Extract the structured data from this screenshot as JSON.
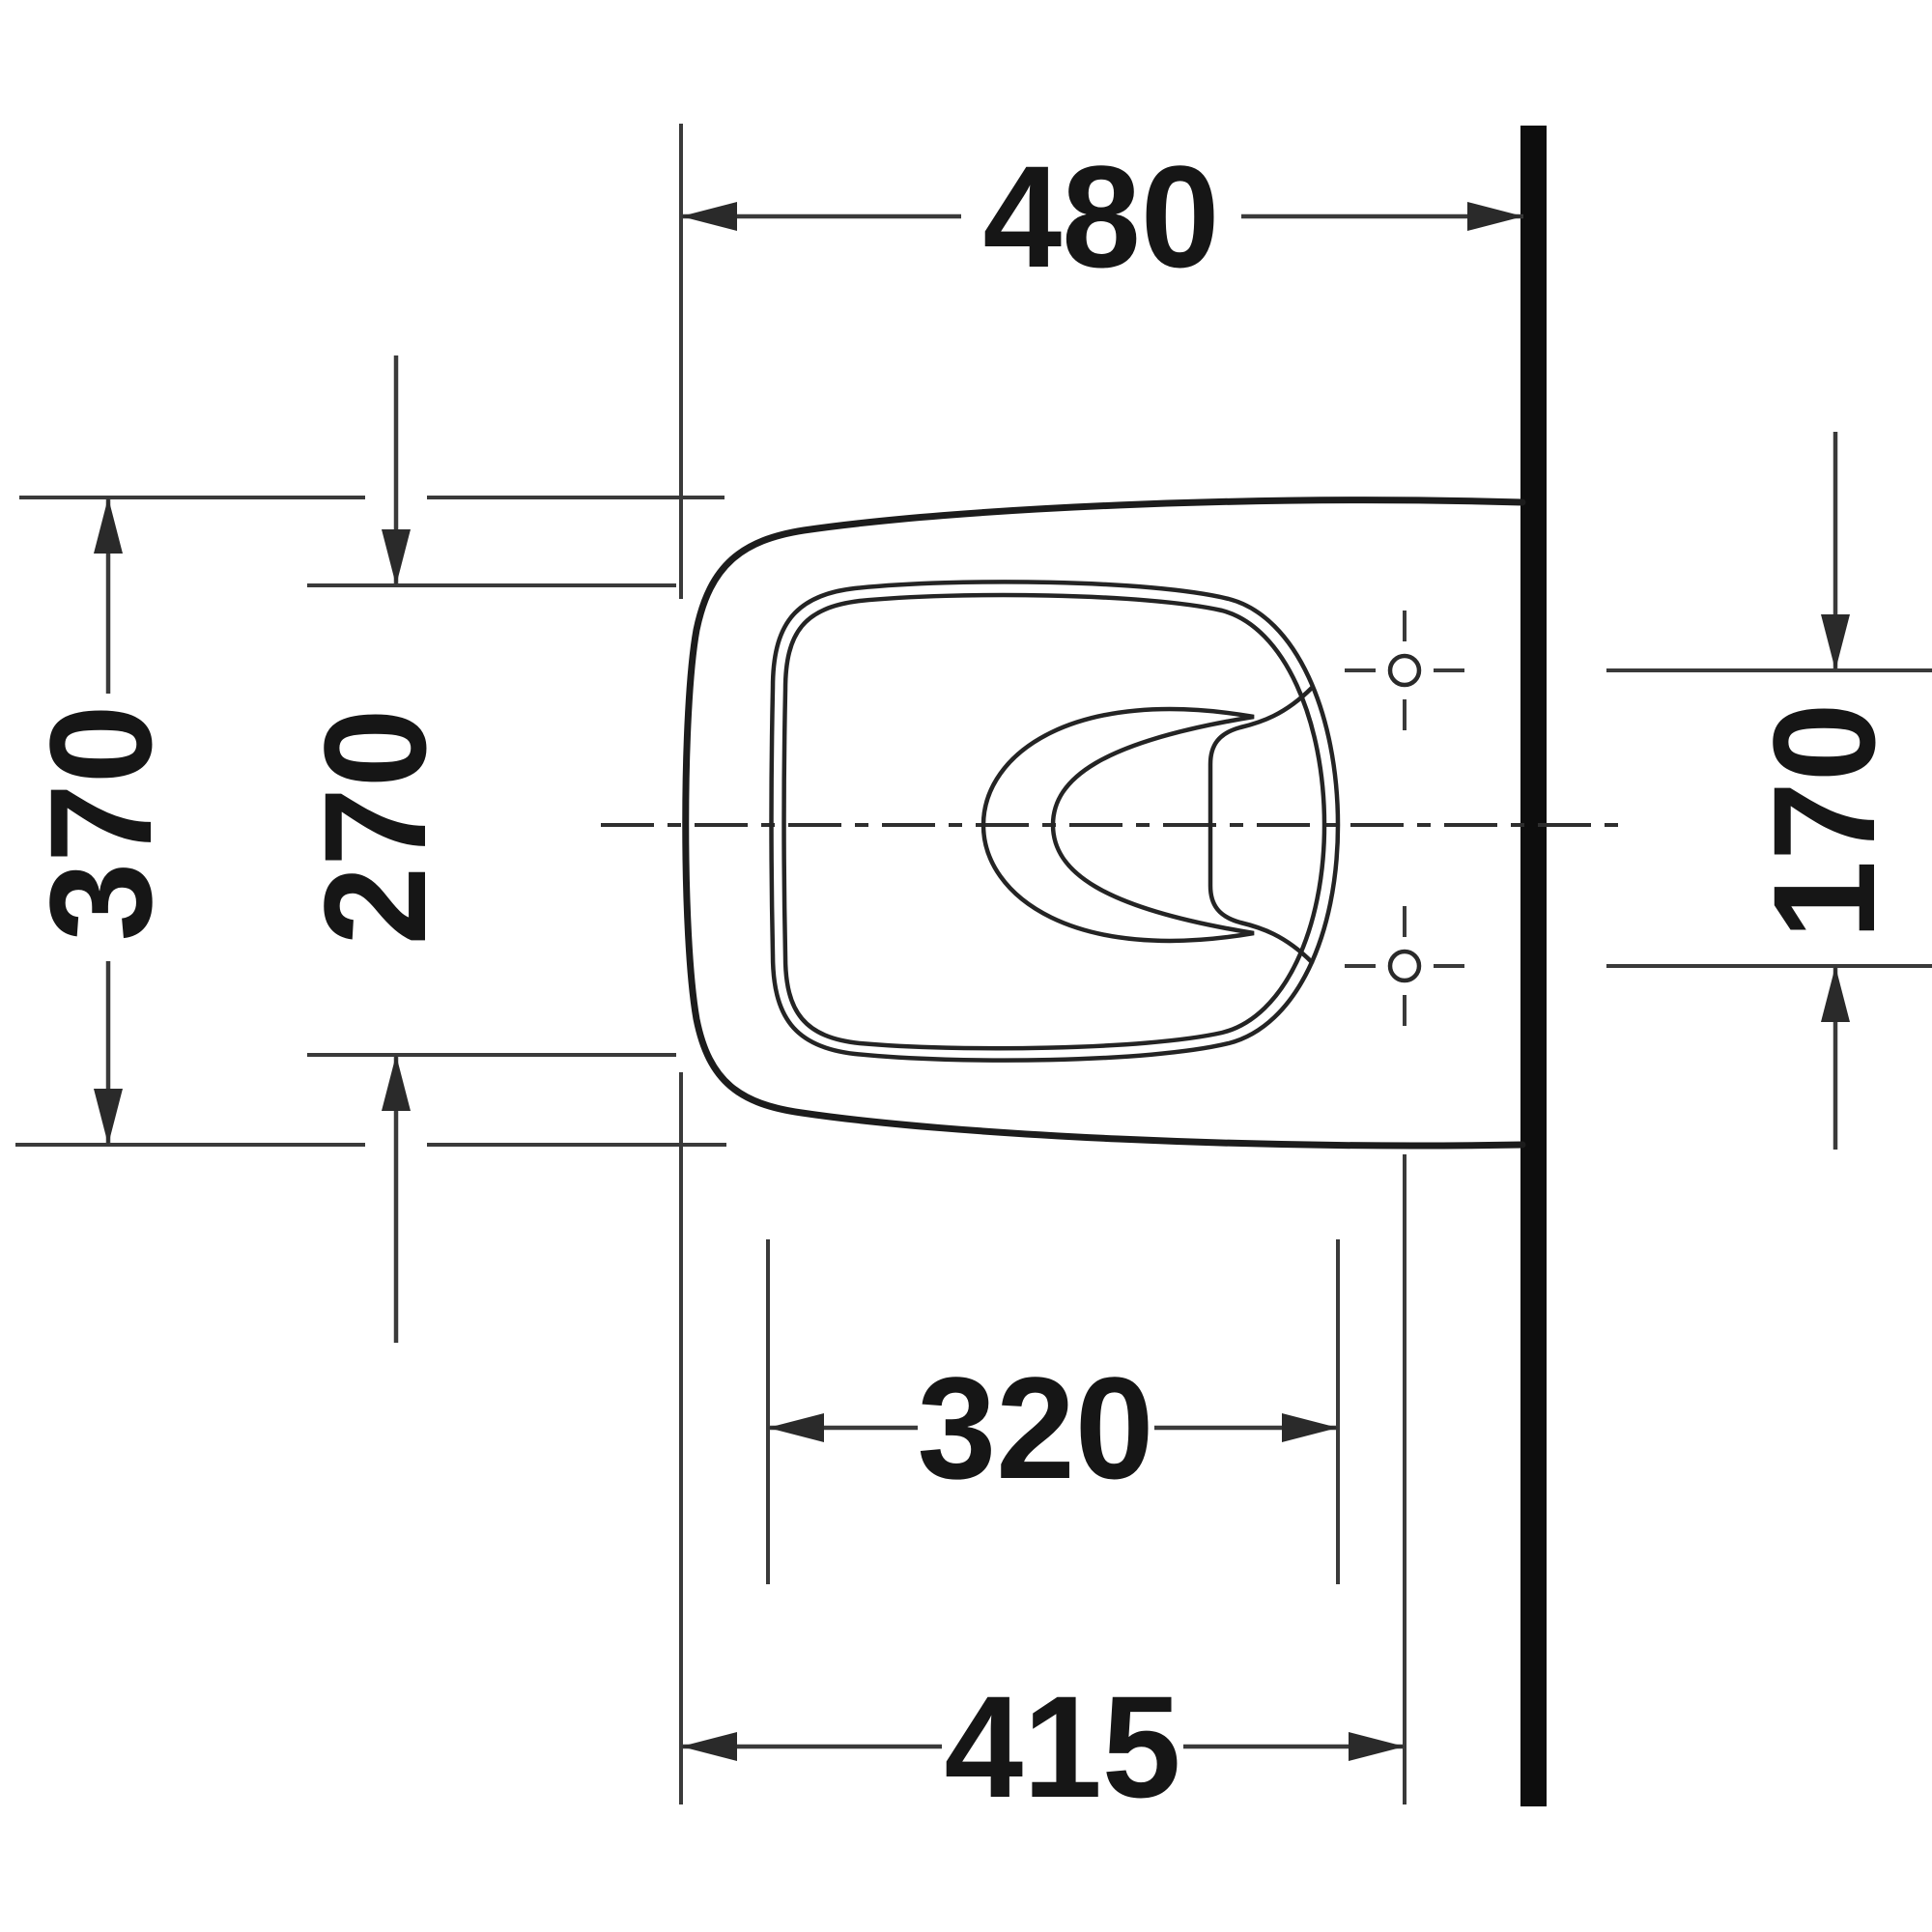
{
  "drawing": {
    "type": "technical-dimension-drawing",
    "view": "toilet-plan-view-wall-hung",
    "dimensions": {
      "overall_depth_top": "480",
      "overall_width_left": "370",
      "seat_opening_width_left": "270",
      "fixing_holes_spacing_right": "170",
      "seat_opening_depth_bottom": "320",
      "front_to_fixing_holes_bottom": "415"
    },
    "colors": {
      "background": "#ffffff",
      "outline": "#1c1c1c",
      "dimension_lines": "#3a3a3a",
      "text": "#161616",
      "wall": "#0d0d0d"
    }
  }
}
